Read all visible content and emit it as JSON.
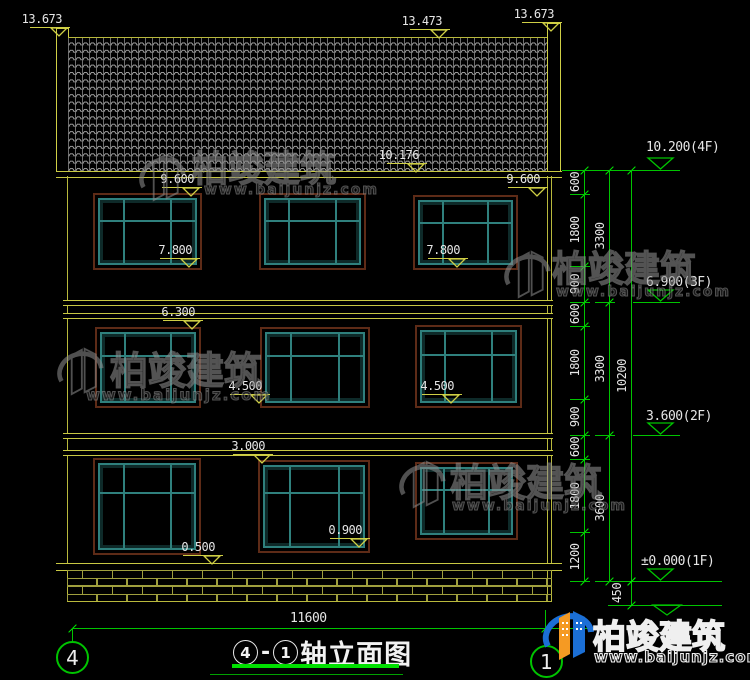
{
  "drawing": {
    "type_label": "轴立面图",
    "axis_from": "4",
    "axis_to": "1",
    "title_dash": "-",
    "bottom_width_dim": "11600",
    "axis_bubble_left": "4",
    "axis_bubble_right": "1"
  },
  "left_markers": [
    {
      "id": "ridge_left",
      "label": "13.673"
    },
    {
      "id": "ridge_mid",
      "label": "13.473"
    },
    {
      "id": "ridge_right",
      "label": "13.673"
    },
    {
      "id": "eave",
      "label": "10.176"
    },
    {
      "id": "f3_lintel_l",
      "label": "9.600"
    },
    {
      "id": "f3_lintel_r",
      "label": "9.600"
    },
    {
      "id": "f3_sill_l",
      "label": "7.800"
    },
    {
      "id": "f3_sill_r",
      "label": "7.800"
    },
    {
      "id": "f2_lintel",
      "label": "6.300"
    },
    {
      "id": "f2_sill_l",
      "label": "4.500"
    },
    {
      "id": "f2_sill_r",
      "label": "4.500"
    },
    {
      "id": "f1_lintel",
      "label": "3.000"
    },
    {
      "id": "f1_sill_l",
      "label": "0.500"
    },
    {
      "id": "f1_sill_r",
      "label": "0.900"
    }
  ],
  "floor_levels": [
    {
      "id": "L4",
      "label": "10.200(4F)"
    },
    {
      "id": "L3",
      "label": "6.900(3F)"
    },
    {
      "id": "L2",
      "label": "3.600(2F)"
    },
    {
      "id": "L1",
      "label": "±0.000(1F)"
    }
  ],
  "dimension_chains": {
    "chain_inner": [
      "600",
      "1800",
      "900",
      "600",
      "1800",
      "900",
      "600",
      "1800",
      "1200"
    ],
    "chain_mid": [
      "3300",
      "3300",
      "3600"
    ],
    "chain_outer": [
      "10200"
    ],
    "plinth_dim": "450"
  },
  "watermark": {
    "name": "柏竣建筑",
    "url": "www.baijunjz.com"
  },
  "logo": {
    "name": "柏竣建筑",
    "url": "www.baijunjz.com"
  }
}
